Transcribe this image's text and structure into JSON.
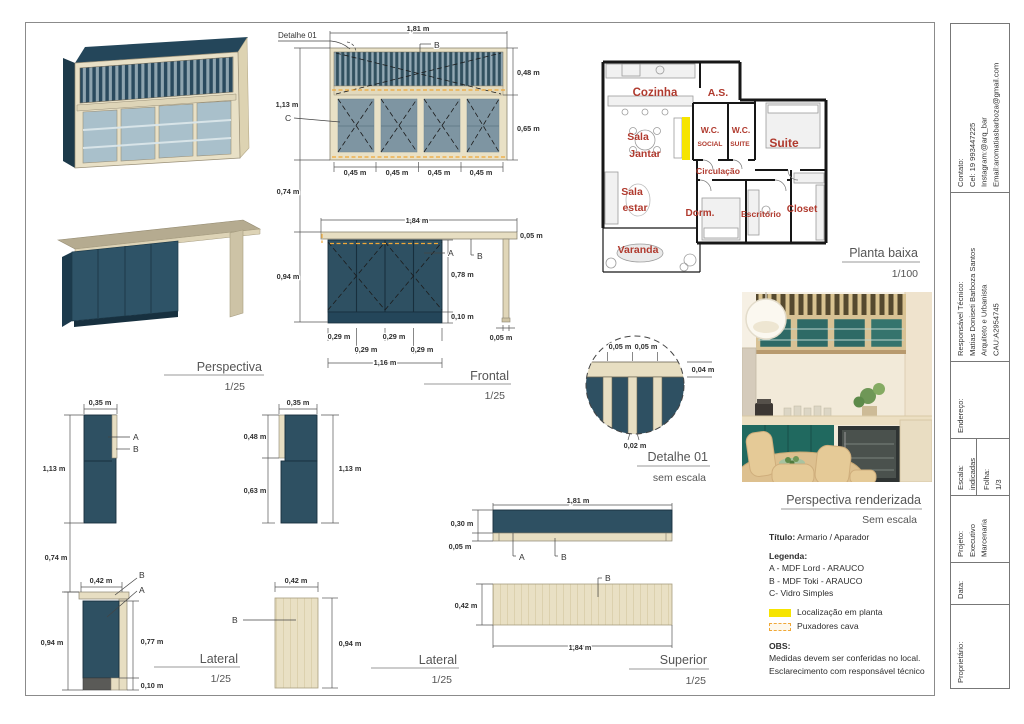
{
  "colors": {
    "navy": "#2e5062",
    "navy_dark": "#1f3c4c",
    "wood": "#e8e0c6",
    "wood_dark": "#d9cfae",
    "counter": "#b5ab90",
    "glass": "#8ba0ac",
    "glass_light": "#a9c0cb",
    "yellow": "#f6e400",
    "orange": "#f0a838",
    "red": "#b03a2e",
    "ink": "#3c3c3c"
  },
  "callouts": {
    "detail": "Detalhe 01",
    "a": "A",
    "b": "B",
    "c": "C"
  },
  "titles": {
    "perspectiva": {
      "name": "Perspectiva",
      "scale": "1/25"
    },
    "frontal": {
      "name": "Frontal",
      "scale": "1/25"
    },
    "detalhe": {
      "name": "Detalhe 01",
      "scale": "sem escala"
    },
    "planta": {
      "name": "Planta baixa",
      "scale": "1/100"
    },
    "render": {
      "name": "Perspectiva renderizada",
      "scale": "Sem escala"
    },
    "lateral1": {
      "name": "Lateral",
      "scale": "1/25"
    },
    "lateral2": {
      "name": "Lateral",
      "scale": "1/25"
    },
    "superior": {
      "name": "Superior",
      "scale": "1/25"
    }
  },
  "dims": {
    "fu_w": "1,81 m",
    "fu_top_h": "0,48 m",
    "fu_h": "1,13 m",
    "fu_door_h": "0,65 m",
    "fu_d1": "0,45 m",
    "fu_d2": "0,45 m",
    "fu_d3": "0,45 m",
    "fu_d4": "0,45 m",
    "gap1": "0,74 m",
    "fl_w": "1,84 m",
    "fl_top_th": "0,05 m",
    "fl_h": "0,94 m",
    "fl_door_h": "0,78 m",
    "fl_plinth": "0,10 m",
    "fl_d1": "0,29 m",
    "fl_d2": "0,29 m",
    "fl_d3": "0,29 m",
    "fl_d4": "0,29 m",
    "fl_cab_w": "1,16 m",
    "fl_leg_w": "0,05 m",
    "dt_s1": "0,05 m",
    "dt_s2": "0,05 m",
    "dt_th": "0,04 m",
    "dt_slat": "0,02 m",
    "lu1_w": "0,35 m",
    "lu1_h": "1,13 m",
    "lu2_w": "0,35 m",
    "lu2_h1": "0,48 m",
    "lu2_h2": "0,63 m",
    "lu2_h": "1,13 m",
    "gap2": "0,74 m",
    "ll_w": "0,42 m",
    "ll_h": "0,94 m",
    "ll_door_h": "0,77 m",
    "ll_plinth": "0,10 m",
    "lp_w": "0,42 m",
    "lp_h": "0,94 m",
    "bf_w": "1,81 m",
    "bf_h": "0,30 m",
    "bf_th": "0,05 m",
    "sp_d": "0,42 m",
    "sp_w": "1,84 m"
  },
  "plan": {
    "rooms": {
      "cozinha": "Cozinha",
      "as": "A.S.",
      "wc1a": "W.C.",
      "wc1b": "SOCIAL",
      "wc2a": "W.C.",
      "wc2b": "SUITE",
      "suite": "Suite",
      "sala1a": "Sala",
      "sala1b": "Jantar",
      "circ": "Circulação",
      "sala2a": "Sala",
      "sala2b": "estar",
      "dorm": "Dorm.",
      "escritorio": "Escritório",
      "closet": "Closet",
      "varanda": "Varanda"
    }
  },
  "legend": {
    "titulo_label": "Título:",
    "titulo_value": "Armario / Aparador",
    "legenda_label": "Legenda:",
    "items": [
      "A - MDF Lord - ARAUCO",
      "B - MDF Toki - ARAUCO",
      "C- Vidro Simples"
    ],
    "loc_label": "Localização em planta",
    "pux_label": "Puxadores cava",
    "obs_label": "OBS:",
    "obs_lines": [
      "Medidas devem ser conferidas no local.",
      "Esclarecimento com responsável técnico"
    ]
  },
  "titleblock": {
    "contato_label": "Contato:",
    "contato_lines": [
      "Cel: 19 993447225",
      "Instagram:@arq_bar",
      "Email:aromatiasbarboza@gmail.com"
    ],
    "resp_label": "Responsável Técnico:",
    "resp_lines": [
      "Matias Doniseti Barboza Santos",
      "Arquiteto e Urbanista",
      "CAU:A2954745"
    ],
    "endereco_label": "Endereço:",
    "escala_label": "Escala:",
    "escala_value": "indicadas",
    "folha_label": "Folha:",
    "folha_value": "1/3",
    "projeto_label": "Projeto:",
    "projeto_lines": [
      "Executivo",
      "Marcenaria"
    ],
    "data_label": "Data:",
    "proprietario_label": "Proprietário:"
  }
}
